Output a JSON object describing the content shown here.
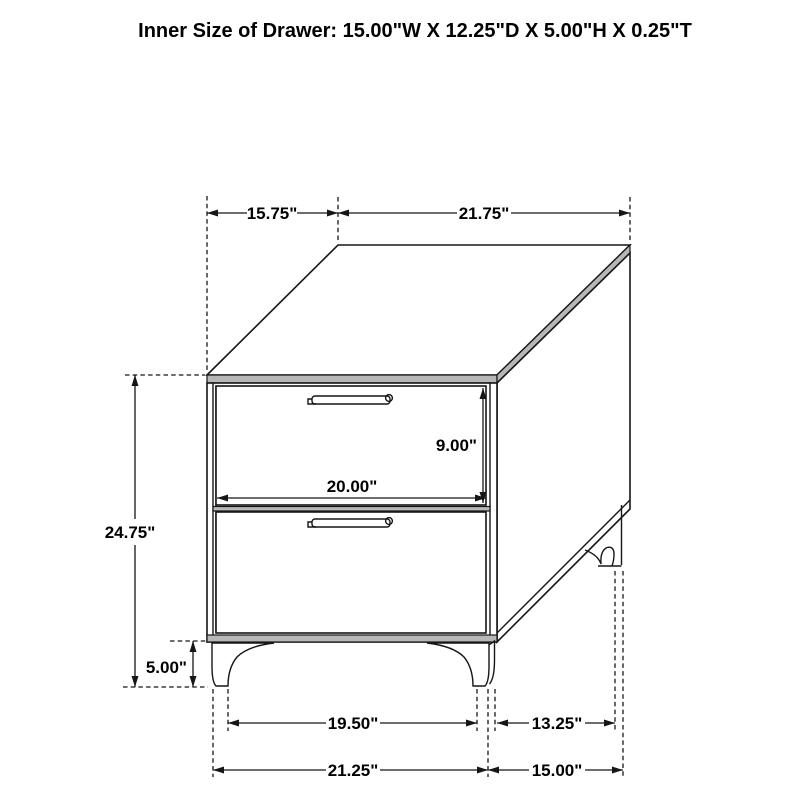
{
  "title": "Inner Size of Drawer: 15.00\"W X 12.25\"D X 5.00\"H X 0.25\"T",
  "figure": {
    "type": "furniture-dimension-diagram",
    "subject": "two-drawer nightstand line drawing",
    "dimensions": {
      "top_depth": "15.75\"",
      "top_width": "21.75\"",
      "drawer_height": "9.00\"",
      "drawer_width": "20.00\"",
      "overall_height": "24.75\"",
      "leg_height": "5.00\"",
      "front_leg_inner_span": "19.50\"",
      "side_leg_inner_span": "13.25\"",
      "front_overall_width": "21.25\"",
      "side_overall_depth": "15.00\""
    },
    "colors": {
      "line": "#161616",
      "edge_band_fill": "#b7b7b7",
      "background": "#ffffff"
    }
  }
}
